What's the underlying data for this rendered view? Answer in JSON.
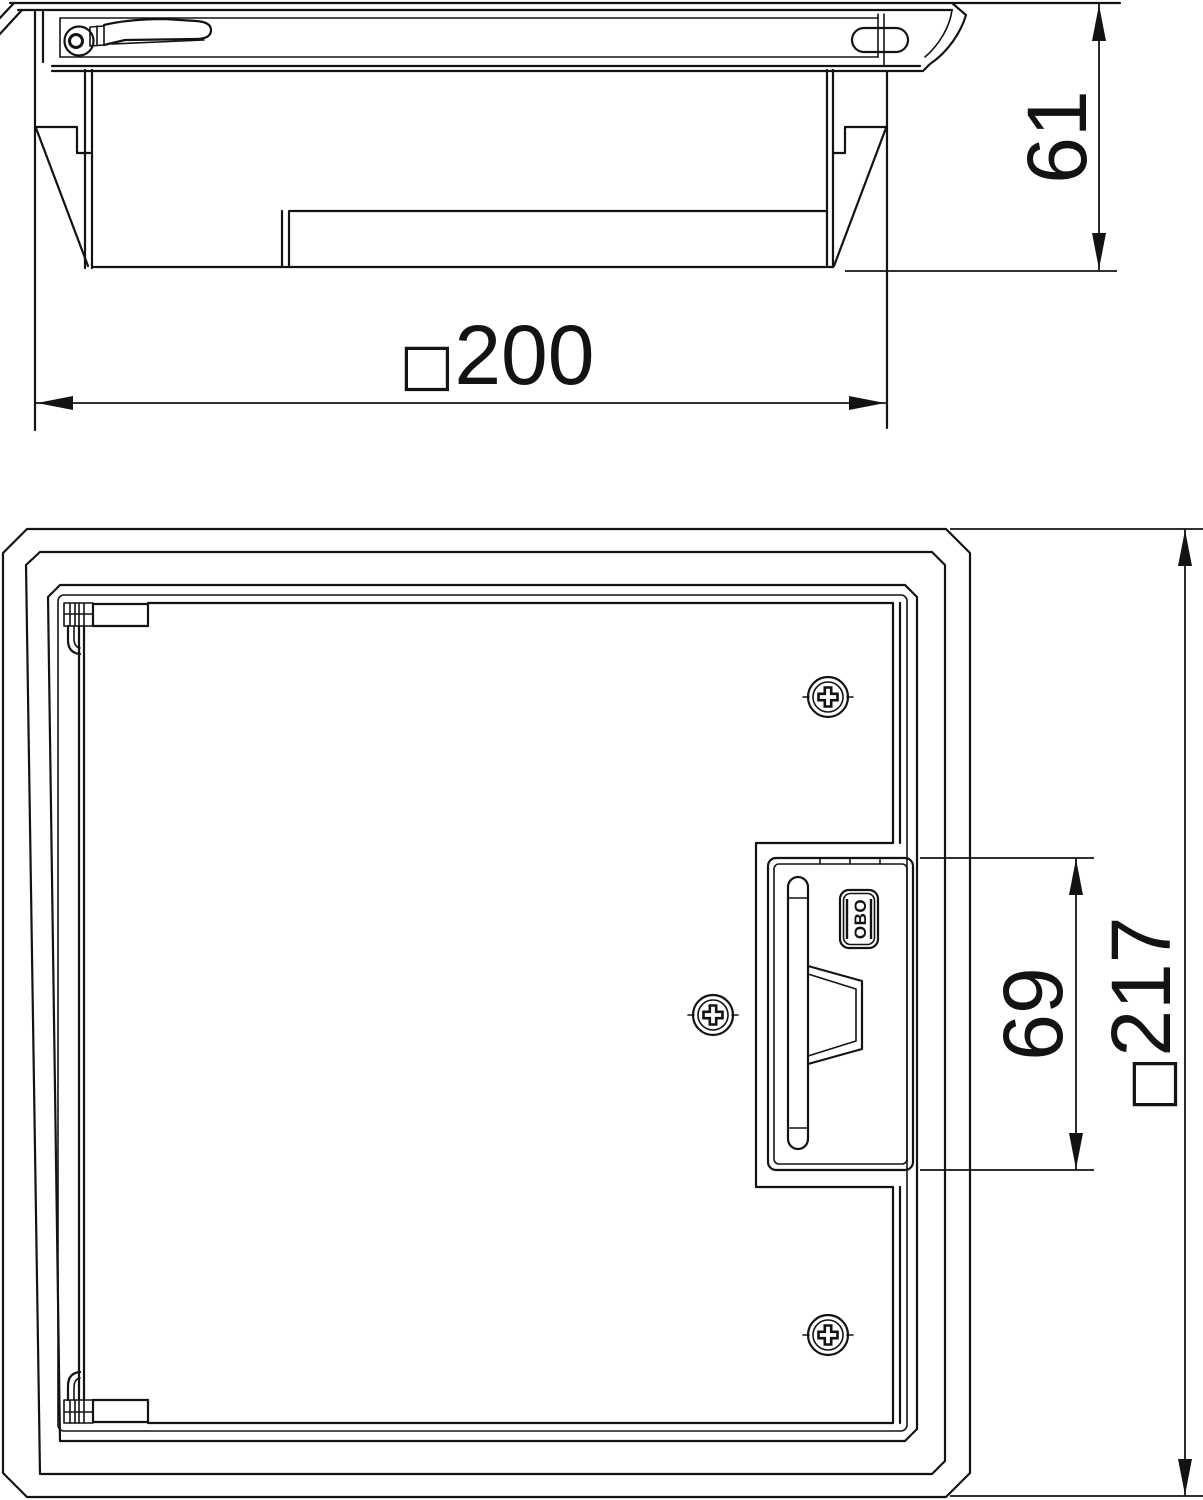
{
  "drawing": {
    "background": "#ffffff",
    "stroke_color": "#131313"
  },
  "section_view": {
    "dim_height": {
      "value": "61"
    },
    "dim_width": {
      "square": "□",
      "value": "200"
    }
  },
  "plan_view": {
    "dim_recess": {
      "value": "69"
    },
    "dim_overall": {
      "square": "□",
      "value": "217"
    },
    "logo": {
      "text": "OBO"
    }
  }
}
